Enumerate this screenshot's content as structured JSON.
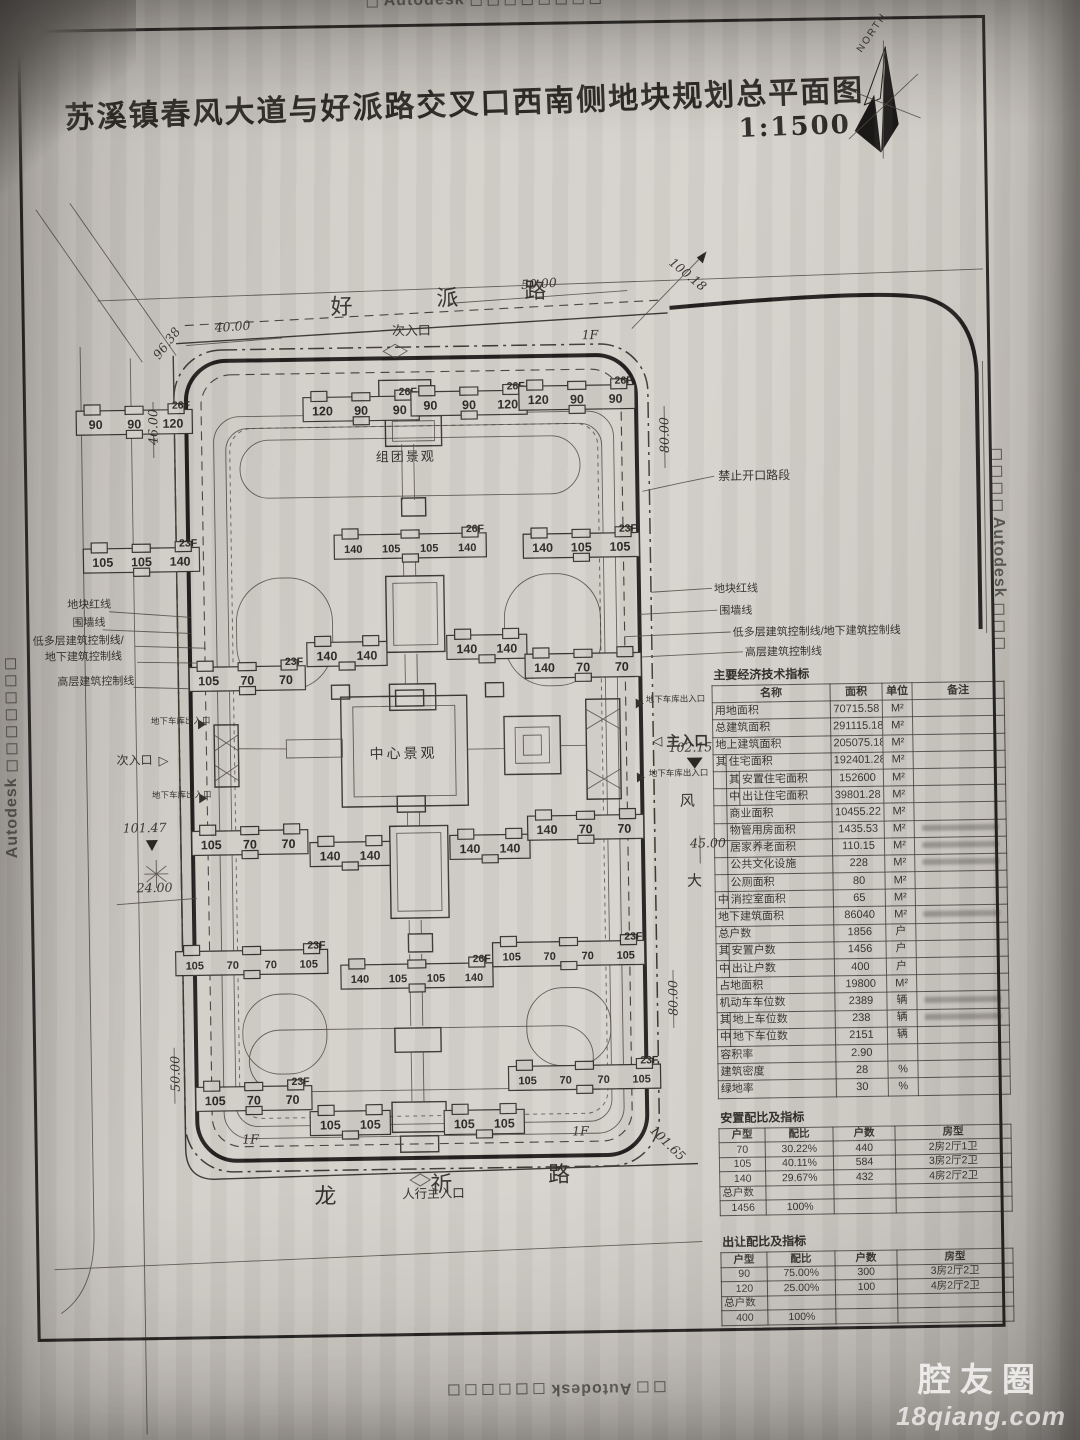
{
  "stamps": {
    "text": "Autodesk"
  },
  "watermark": {
    "line1": "腔友圈",
    "line2": "18qiang.com"
  },
  "title": {
    "text": "苏溪镇春风大道与好派路交叉口西南侧地块规划总平面图",
    "scale": "1:1500",
    "north": "NORTH"
  },
  "plan": {
    "roads": {
      "top": "好派路",
      "bottom": "龙祈路",
      "right_partial": "风大"
    },
    "labels": {
      "sub_entrance_top": "次入口",
      "main_entrance": "主入口",
      "ped_entrance": "人行主入口",
      "side_entrance": "次入口",
      "garage": "地下车库出入口",
      "no_open": "禁止开口路段",
      "center_landscape": "中心景观",
      "cluster_landscape": "组团景观",
      "left_lines": [
        "地块红线",
        "围墙线",
        "低多层建筑控制线/",
        "地下建筑控制线",
        "高层建筑控制线"
      ],
      "right_lines": [
        "地块红线",
        "围墙线",
        "低多层建筑控制线/地下建筑控制线",
        "高层建筑控制线"
      ]
    },
    "dims": [
      {
        "t": "40.00",
        "x": 253,
        "y": 338,
        "r": -3
      },
      {
        "t": "96.38",
        "x": 190,
        "y": 352,
        "r": -52
      },
      {
        "t": "50.00",
        "x": 560,
        "y": 300,
        "r": -3
      },
      {
        "t": "100.18",
        "x": 706,
        "y": 292,
        "r": 40
      },
      {
        "t": "46.00",
        "x": 176,
        "y": 433,
        "r": -90
      },
      {
        "t": "1F",
        "x": 610,
        "y": 352,
        "r": 0
      },
      {
        "t": "80.00",
        "x": 687,
        "y": 449,
        "r": -90
      },
      {
        "t": "102.15",
        "x": 704,
        "y": 766,
        "r": 0
      },
      {
        "t": "45.00",
        "x": 720,
        "y": 862,
        "r": 0
      },
      {
        "t": "80.00",
        "x": 687,
        "y": 1012,
        "r": -90
      },
      {
        "t": "101.47",
        "x": 157,
        "y": 838,
        "r": 0
      },
      {
        "t": "24.00",
        "x": 166,
        "y": 898,
        "r": 0
      },
      {
        "t": "50.00",
        "x": 188,
        "y": 1080,
        "r": -90
      },
      {
        "t": "1F",
        "x": 258,
        "y": 1151,
        "r": 0
      },
      {
        "t": "1F",
        "x": 588,
        "y": 1148,
        "r": 0
      },
      {
        "t": "101.65",
        "x": 672,
        "y": 1160,
        "r": 45
      }
    ],
    "buildings": [
      {
        "x": 95,
        "y": 410,
        "u": [
          "90",
          "90",
          "120"
        ],
        "f": "26F"
      },
      {
        "x": 322,
        "y": 400,
        "u": [
          "120",
          "90",
          "90"
        ],
        "f": "26F"
      },
      {
        "x": 430,
        "y": 396,
        "u": [
          "90",
          "90",
          "120"
        ],
        "f": "26F"
      },
      {
        "x": 538,
        "y": 392,
        "u": [
          "120",
          "90",
          "90"
        ],
        "f": "26F"
      },
      {
        "x": 100,
        "y": 548,
        "u": [
          "105",
          "105",
          "140"
        ],
        "f": "23F"
      },
      {
        "x": 351,
        "y": 538,
        "u": [
          "140",
          "105",
          "105",
          "140"
        ],
        "f": "26F"
      },
      {
        "x": 540,
        "y": 540,
        "u": [
          "140",
          "105",
          "105"
        ],
        "f": "23F"
      },
      {
        "x": 204,
        "y": 668,
        "u": [
          "105",
          "70",
          "70"
        ],
        "f": "23F"
      },
      {
        "x": 322,
        "y": 645,
        "u": [
          "140",
          "140"
        ],
        "f": ""
      },
      {
        "x": 462,
        "y": 640,
        "u": [
          "140",
          "140"
        ],
        "f": ""
      },
      {
        "x": 540,
        "y": 660,
        "u": [
          "140",
          "70",
          "70"
        ],
        "f": ""
      },
      {
        "x": 204,
        "y": 832,
        "u": [
          "105",
          "70",
          "70"
        ],
        "f": ""
      },
      {
        "x": 322,
        "y": 845,
        "u": [
          "140",
          "140"
        ],
        "f": ""
      },
      {
        "x": 462,
        "y": 840,
        "u": [
          "140",
          "140"
        ],
        "f": ""
      },
      {
        "x": 540,
        "y": 822,
        "u": [
          "140",
          "70",
          "70"
        ],
        "f": ""
      },
      {
        "x": 186,
        "y": 952,
        "u": [
          "105",
          "70",
          "70",
          "105"
        ],
        "f": "23F"
      },
      {
        "x": 351,
        "y": 968,
        "u": [
          "140",
          "105",
          "105",
          "140"
        ],
        "f": "26F"
      },
      {
        "x": 503,
        "y": 948,
        "u": [
          "105",
          "70",
          "70",
          "105"
        ],
        "f": "23F"
      },
      {
        "x": 204,
        "y": 1088,
        "u": [
          "105",
          "70",
          "70"
        ],
        "f": "23F"
      },
      {
        "x": 318,
        "y": 1114,
        "u": [
          "105",
          "105"
        ],
        "f": ""
      },
      {
        "x": 452,
        "y": 1115,
        "u": [
          "105",
          "105"
        ],
        "f": ""
      },
      {
        "x": 517,
        "y": 1072,
        "u": [
          "105",
          "70",
          "70",
          "105"
        ],
        "f": "23F"
      }
    ]
  },
  "tables": {
    "main": {
      "title": "主要经济技术指标",
      "headers": [
        "名称",
        "面积",
        "单位",
        "备注"
      ],
      "rows": [
        {
          "ind": 0,
          "c1": "",
          "c2": "",
          "name": "用地面积",
          "v": "70715.58",
          "u": "M²",
          "rb": false
        },
        {
          "ind": 0,
          "c1": "",
          "c2": "",
          "name": "总建筑面积",
          "v": "291115.18",
          "u": "M²",
          "rb": false
        },
        {
          "ind": 0,
          "c1": "",
          "c2": "",
          "name": "地上建筑面积",
          "v": "205075.18",
          "u": "M²",
          "rb": false
        },
        {
          "ind": 1,
          "c1": "其",
          "c2": "",
          "name": "住宅面积",
          "v": "192401.28",
          "u": "M²",
          "rb": false
        },
        {
          "ind": 2,
          "c1": "",
          "c2": "其",
          "name": "安置住宅面积",
          "v": "152600",
          "u": "M²",
          "rb": false
        },
        {
          "ind": 2,
          "c1": "",
          "c2": "中",
          "name": "出让住宅面积",
          "v": "39801.28",
          "u": "M²",
          "rb": false
        },
        {
          "ind": 1,
          "c1": "",
          "c2": "",
          "name": "商业面积",
          "v": "10455.22",
          "u": "M²",
          "rb": false
        },
        {
          "ind": 1,
          "c1": "",
          "c2": "",
          "name": "物管用房面积",
          "v": "1435.53",
          "u": "M²",
          "rb": true
        },
        {
          "ind": 1,
          "c1": "",
          "c2": "",
          "name": "居家养老面积",
          "v": "110.15",
          "u": "M²",
          "rb": true
        },
        {
          "ind": 1,
          "c1": "",
          "c2": "",
          "name": "公共文化设施",
          "v": "228",
          "u": "M²",
          "rb": true
        },
        {
          "ind": 1,
          "c1": "",
          "c2": "",
          "name": "公厕面积",
          "v": "80",
          "u": "M²",
          "rb": false
        },
        {
          "ind": 1,
          "c1": "中",
          "c2": "",
          "name": "消控室面积",
          "v": "65",
          "u": "M²",
          "rb": false
        },
        {
          "ind": 0,
          "c1": "",
          "c2": "",
          "name": "地下建筑面积",
          "v": "86040",
          "u": "M²",
          "rb": true
        },
        {
          "ind": 0,
          "c1": "",
          "c2": "",
          "name": "总户数",
          "v": "1856",
          "u": "户",
          "rb": false
        },
        {
          "ind": 1,
          "c1": "其",
          "c2": "",
          "name": "安置户数",
          "v": "1456",
          "u": "户",
          "rb": false
        },
        {
          "ind": 1,
          "c1": "中",
          "c2": "",
          "name": "出让户数",
          "v": "400",
          "u": "户",
          "rb": false
        },
        {
          "ind": 0,
          "c1": "",
          "c2": "",
          "name": "占地面积",
          "v": "19800",
          "u": "M²",
          "rb": false
        },
        {
          "ind": 0,
          "c1": "",
          "c2": "",
          "name": "机动车车位数",
          "v": "2389",
          "u": "辆",
          "rb": true
        },
        {
          "ind": 1,
          "c1": "其",
          "c2": "",
          "name": "地上车位数",
          "v": "238",
          "u": "辆",
          "rb": true
        },
        {
          "ind": 1,
          "c1": "中",
          "c2": "",
          "name": "地下车位数",
          "v": "2151",
          "u": "辆",
          "rb": false
        },
        {
          "ind": 0,
          "c1": "",
          "c2": "",
          "name": "容积率",
          "v": "2.90",
          "u": "",
          "rb": false
        },
        {
          "ind": 0,
          "c1": "",
          "c2": "",
          "name": "建筑密度",
          "v": "28",
          "u": "%",
          "rb": false
        },
        {
          "ind": 0,
          "c1": "",
          "c2": "",
          "name": "绿地率",
          "v": "30",
          "u": "%",
          "rb": false
        }
      ]
    },
    "ratio1": {
      "title": "安置配比及指标",
      "headers": [
        "户型",
        "配比",
        "户数",
        "房型"
      ],
      "rows": [
        [
          "70",
          "30.22%",
          "440",
          "2房2厅1卫"
        ],
        [
          "105",
          "40.11%",
          "584",
          "3房2厅2卫"
        ],
        [
          "140",
          "29.67%",
          "432",
          "4房2厅2卫"
        ]
      ],
      "total_label": "总户数",
      "total": [
        "1456",
        "100%",
        "",
        ""
      ]
    },
    "ratio2": {
      "title": "出让配比及指标",
      "headers": [
        "户型",
        "配比",
        "户数",
        "房型"
      ],
      "rows": [
        [
          "90",
          "75.00%",
          "300",
          "3房2厅2卫"
        ],
        [
          "120",
          "25.00%",
          "100",
          "4房2厅2卫"
        ]
      ],
      "total_label": "总户数",
      "total": [
        "400",
        "100%",
        "",
        ""
      ]
    }
  }
}
